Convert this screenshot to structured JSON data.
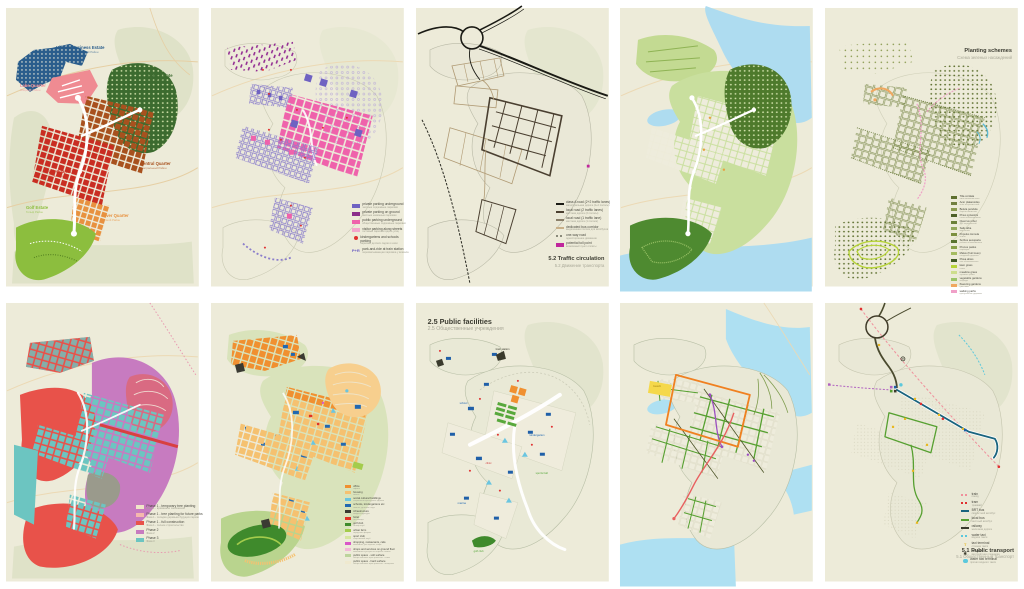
{
  "page": {
    "background": "#ffffff",
    "paper_color": "#edebd9"
  },
  "panels": [
    {
      "name": "masterplan",
      "districts": [
        {
          "text": "Hillside Business Estate",
          "sub": "Деловой Международный Район",
          "color": "#2a5d8c"
        },
        {
          "text": "Lake Quarter",
          "sub": "Озёрный Район",
          "color": "#ef8b92"
        },
        {
          "text": "Forest Estate",
          "sub": "Лесной Район",
          "color": "#3c6b2f"
        },
        {
          "text": "Central Quarter",
          "sub": "Центральный Район",
          "color": "#a8511e"
        },
        {
          "text": "Park Quarter",
          "sub": "Парковый Район",
          "color": "#c92d22"
        },
        {
          "text": "River Quarter",
          "sub": "Речной Район",
          "color": "#e8913f"
        },
        {
          "text": "Golf Estate",
          "sub": "Гольф Район",
          "color": "#8cbe3e"
        }
      ]
    },
    {
      "name": "parking",
      "legend": [
        {
          "shape": "square",
          "color": "#6f62c2",
          "label": "private parking underground",
          "sub": "частные подземные парковки"
        },
        {
          "shape": "square",
          "color": "#8b2e8b",
          "label": "private parking on ground",
          "sub": "частные наземные парковки"
        },
        {
          "shape": "square",
          "color": "#ef62ab",
          "label": "public parking underground",
          "sub": "общественные подземные парковки"
        },
        {
          "shape": "square",
          "color": "#f4a6cc",
          "label": "visitor parking along streets",
          "sub": "гостевые парковки вдоль улиц"
        },
        {
          "shape": "dot",
          "color": "#e03030",
          "label": "kindergartens and schools parking",
          "sub": "парковки детских садов и школ"
        },
        {
          "shape": "text",
          "glyph": "P+R",
          "color": "#6f62c2",
          "label": "park-and-ride at train station",
          "sub": "перехватывающая парковка у вокзала"
        }
      ]
    },
    {
      "name": "traffic",
      "title": "5.2 Traffic circulation",
      "subtitle": "5.2 Движение транспорта",
      "legend": [
        {
          "shape": "line",
          "color": "#1a1a14",
          "label": "class A road (2+2 traffic lanes)",
          "sub": "магистральная дорога (2+2 полосы)"
        },
        {
          "shape": "line",
          "color": "#4a3f30",
          "label": "local road (2 traffic lanes)",
          "sub": "местная дорога (2 полосы)"
        },
        {
          "shape": "line",
          "color": "#8a7f6a",
          "label": "local road (1 traffic lane)",
          "sub": "местная дорога (1 полоса)"
        },
        {
          "shape": "line",
          "color": "#c9b089",
          "label": "dedicated bus corridor",
          "sub": "выделенная полоса для автобусов"
        },
        {
          "shape": "dash",
          "color": "#8a8a7a",
          "label": "one-way road",
          "sub": "одностороннее движение"
        },
        {
          "shape": "square",
          "color": "#c0269c",
          "label": "potential toll point",
          "sub": "возможный пункт оплаты"
        }
      ]
    },
    {
      "name": "landscape"
    },
    {
      "name": "planting",
      "title": "Planting schemes",
      "subtitle": "Схема зеленых насаждений",
      "legend": [
        {
          "shape": "square",
          "color": "#5e7030",
          "label": "Tilia cordata",
          "sub": "липа мелколистная"
        },
        {
          "shape": "square",
          "color": "#728040",
          "label": "Acer platanoides",
          "sub": "клён остролистный"
        },
        {
          "shape": "square",
          "color": "#8a9a50",
          "label": "Betula pendula",
          "sub": "берёза повислая"
        },
        {
          "shape": "square",
          "color": "#4e6028",
          "label": "Pinus sylvestris",
          "sub": "сосна обыкновенная"
        },
        {
          "shape": "square",
          "color": "#6b8038",
          "label": "Quercus robur",
          "sub": "дуб черешчатый"
        },
        {
          "shape": "square",
          "color": "#93a85c",
          "label": "Salix alba",
          "sub": "ива белая"
        },
        {
          "shape": "square",
          "color": "#7c9040",
          "label": "Populus tremula",
          "sub": "осина"
        },
        {
          "shape": "square",
          "color": "#5a7430",
          "label": "Sorbus aucuparia",
          "sub": "рябина обыкновенная"
        },
        {
          "shape": "square",
          "color": "#88a048",
          "label": "Prunus padus",
          "sub": "черёмуха"
        },
        {
          "shape": "square",
          "color": "#a5bc60",
          "label": "Malus (fruit trees)",
          "sub": "плодовые деревья"
        },
        {
          "shape": "square",
          "color": "#3f5a24",
          "label": "Picea abies",
          "sub": "ель обыкновенная"
        },
        {
          "shape": "square",
          "color": "#b6d437",
          "label": "lawn grass",
          "sub": "газон"
        },
        {
          "shape": "square",
          "color": "#cede8c",
          "label": "meadow grass",
          "sub": "луговые травы"
        },
        {
          "shape": "square",
          "color": "#9cc468",
          "label": "vegetable gardens",
          "sub": "огороды"
        },
        {
          "shape": "square",
          "color": "#f0a860",
          "label": "flowering gardens",
          "sub": "цветники"
        },
        {
          "shape": "square",
          "color": "#f0a0c8",
          "label": "walking paths",
          "sub": "прогулочные дорожки"
        }
      ]
    },
    {
      "name": "phasing",
      "legend": [
        {
          "shape": "square",
          "color": "#f0e6c8",
          "label": "Phase 1 - temporary tree planting",
          "sub": "Фаза 1 - временное озеленение"
        },
        {
          "shape": "square",
          "color": "#f5b8ad",
          "label": "Phase 1 - tree planting for future parks",
          "sub": "Фаза 1 - посадка деревьев будущих парков"
        },
        {
          "shape": "square",
          "color": "#e8524a",
          "label": "Phase 1 - full construction",
          "sub": "Фаза 1 - полное строительство"
        },
        {
          "shape": "square",
          "color": "#c77bc0",
          "label": "Phase 2",
          "sub": "Фаза 2"
        },
        {
          "shape": "square",
          "color": "#6cc5c1",
          "label": "Phase 3",
          "sub": "Фаза 3"
        }
      ]
    },
    {
      "name": "landuse",
      "legend": [
        {
          "shape": "square",
          "color": "#f09030",
          "label": "office",
          "sub": "офисы"
        },
        {
          "shape": "square",
          "color": "#f5c170",
          "label": "housing",
          "sub": "жильё"
        },
        {
          "shape": "square",
          "color": "#6ac5e0",
          "label": "social cultural buildings",
          "sub": "социально-культурные здания"
        },
        {
          "shape": "square",
          "color": "#2268b0",
          "label": "schools, kindergartens etc",
          "sub": "школы, детские сады"
        },
        {
          "shape": "square",
          "color": "#3a3a32",
          "label": "infrastructure",
          "sub": "инфраструктура"
        },
        {
          "shape": "square",
          "color": "#e03226",
          "label": "hotel",
          "sub": "гостиницы"
        },
        {
          "shape": "square",
          "color": "#3f8a2c",
          "label": "golf club",
          "sub": "гольф-клуб"
        },
        {
          "shape": "square",
          "color": "#a4cc4c",
          "label": "urban farm",
          "sub": "городская ферма"
        },
        {
          "shape": "square",
          "color": "#d6e6a0",
          "label": "sport club",
          "sub": "спортивный клуб"
        },
        {
          "shape": "square",
          "color": "#d957c8",
          "label": "shopping, restaurants, cafe",
          "sub": "магазины, рестораны, кафе"
        },
        {
          "shape": "square",
          "color": "#f2b8d8",
          "label": "shops and services on ground floor",
          "sub": "магазины и услуги на первых этажах"
        },
        {
          "shape": "square",
          "color": "#bcd49c",
          "label": "public space - soft surface",
          "sub": "общественные пространства - газон"
        },
        {
          "shape": "square",
          "color": "#efe9cf",
          "label": "public space - hard surface",
          "sub": "общественные пространства - мощение"
        }
      ]
    },
    {
      "name": "facilities",
      "title": "2.5 Public facilities",
      "subtitle": "2.5 Общественные учреждения",
      "map_labels": [
        {
          "text": "train station",
          "color": "#3a3a2c"
        },
        {
          "text": "school",
          "color": "#2268b0"
        },
        {
          "text": "kindergarten",
          "color": "#2268b0"
        },
        {
          "text": "clinic",
          "color": "#d04040"
        },
        {
          "text": "sports hall",
          "color": "#58a83c"
        },
        {
          "text": "marina",
          "color": "#2268b0"
        },
        {
          "text": "golf club",
          "color": "#58a83c"
        }
      ]
    },
    {
      "name": "streets",
      "map_labels": [
        {
          "text": "beach",
          "color": "#b8981f"
        }
      ]
    },
    {
      "name": "transport",
      "title": "5.1 Public transport",
      "subtitle": "5.1 Общественный транспорт",
      "legend": [
        {
          "shape": "dash",
          "color": "#f08f9b",
          "label": "train",
          "sub": "поезд"
        },
        {
          "shape": "dash",
          "color": "#e03030",
          "label": "tram",
          "sub": "трамвай"
        },
        {
          "shape": "line",
          "color": "#19647e",
          "label": "BRT bus",
          "sub": "скоростной автобус"
        },
        {
          "shape": "line",
          "color": "#56a030",
          "label": "local bus",
          "sub": "местный автобус"
        },
        {
          "shape": "line",
          "color": "#3a3a2c",
          "label": "railway",
          "sub": "железная дорога"
        },
        {
          "shape": "dash",
          "color": "#5bc8dc",
          "label": "water taxi",
          "sub": "водное такси"
        },
        {
          "shape": "text",
          "glyph": "T",
          "color": "#e8b820",
          "label": "taxi terminal",
          "sub": "стоянка такси"
        },
        {
          "shape": "text",
          "glyph": "✱",
          "color": "#3a3a2c",
          "label": "heliport",
          "sub": "вертолётная площадка"
        },
        {
          "shape": "circle",
          "color": "#5bc8dc",
          "label": "water taxi terminal",
          "sub": "причал водного такси"
        }
      ]
    }
  ]
}
